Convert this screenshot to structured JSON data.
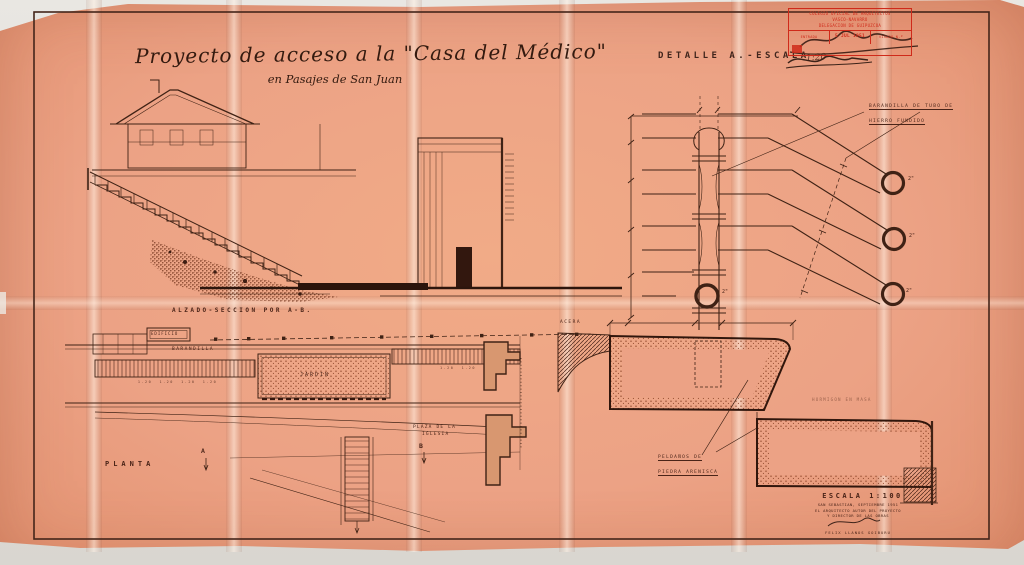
{
  "colors": {
    "paper": "#eca285",
    "ink": "#3a2014",
    "red": "#cc2418"
  },
  "title": {
    "main": "Proyecto de acceso a la \"Casa del Médico\"",
    "subtitle": "en Pasajes de San Juan"
  },
  "stamp": {
    "line1": "COLEGIO OFICIAL DE ARQUITECTOS",
    "line2": "VASCO-NAVARRO",
    "line3": "DELEGACION DE GUIPUZCOA",
    "cell_left": "ENTRADA",
    "date": "5 JUL 1951",
    "cell_right": "VISADO N.º"
  },
  "detail_a": {
    "heading": "DETALLE A.-ESCALA",
    "handwritten_scale": "1:20",
    "railing_label_line1": "BARANDILLA DE TUBO DE",
    "railing_label_line2": "HIERRO FUNDIDO",
    "diameters": [
      "2\"",
      "2\"",
      "2\"",
      "2\""
    ]
  },
  "elevation": {
    "caption": "ALZADO-SECCION POR A-B."
  },
  "plan": {
    "caption": "PLANTA",
    "edificio_label": "EDIFICIO",
    "barandilla_label": "BARANDILLA",
    "jardin_label": "JARDIN",
    "plaza_line1": "PLAZA DE LA",
    "plaza_line2": "IGLESIA",
    "marker_a": "A",
    "marker_b": "B",
    "dim_row_left": "1.20  1.20  1.20  1.20",
    "dim_row_right": "1.20  1.20"
  },
  "step_detail": {
    "acera_label": "ACERA",
    "steps_label_line1": "PELDAÑOS DE",
    "steps_label_line2": "PIEDRA ARENISCA",
    "hormigon_label": "HORMIGON EN MASA"
  },
  "footer": {
    "scale": "ESCALA 1:100",
    "line1": "SAN SEBASTIAN, SEPTIEMBRE 1951",
    "line2": "EL ARQUITECTO AUTOR DEL PROYECTO",
    "line3": "Y DIRECTOR DE LAS OBRAS",
    "name": "FELIX LLANOS GOIBURU"
  }
}
